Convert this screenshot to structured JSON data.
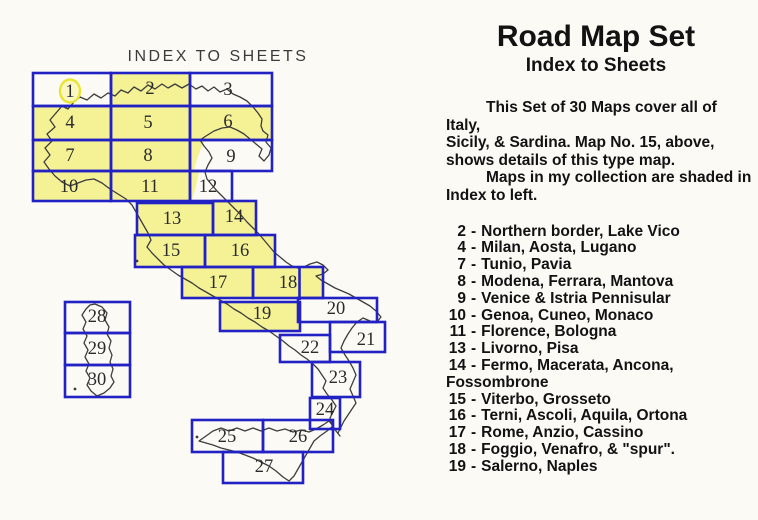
{
  "page": {
    "background": "#fbfaf5"
  },
  "header": {
    "title": "Road Map Set",
    "subtitle": "Index to Sheets"
  },
  "intro": {
    "lines": [
      {
        "text": "This Set of 30 Maps cover all of Italy,",
        "indent": true
      },
      {
        "text": "Sicily, & Sardina.  Map No. 15, above,",
        "indent": false
      },
      {
        "text": "shows details of this type map.",
        "indent": false
      },
      {
        "text": "Maps in my collection are shaded in",
        "indent": true
      },
      {
        "text": "Index to left.",
        "indent": false
      }
    ]
  },
  "sheet_list": {
    "separator": "-",
    "items": [
      {
        "num": "2",
        "desc": "Northern border, Lake Vico"
      },
      {
        "num": "4",
        "desc": "Milan, Aosta, Lugano"
      },
      {
        "num": "7",
        "desc": "Tunio, Pavia"
      },
      {
        "num": "8",
        "desc": "Modena, Ferrara, Mantova"
      },
      {
        "num": "9",
        "desc": "Venice & Istria Pennisular"
      },
      {
        "num": "10",
        "desc": "Genoa, Cuneo, Monaco"
      },
      {
        "num": "11",
        "desc": "Florence, Bologna"
      },
      {
        "num": "13",
        "desc": "Livorno, Pisa"
      },
      {
        "num": "14",
        "desc": "Fermo, Macerata, Ancona,",
        "continuation": "Fossombrone"
      },
      {
        "num": "15",
        "desc": "Viterbo, Grosseto"
      },
      {
        "num": "16",
        "desc": "Terni, Ascoli, Aquila, Ortona"
      },
      {
        "num": "17",
        "desc": "Rome, Anzio, Cassino"
      },
      {
        "num": "18",
        "desc": "Foggio, Venafro, & \"spur\"."
      },
      {
        "num": "19",
        "desc": "Salerno, Naples"
      }
    ]
  },
  "index_map": {
    "title": "INDEX TO SHEETS",
    "total_sheets": 30,
    "highlighted_sheet": "1",
    "colors": {
      "grid": "#2222c4",
      "shaded": "#f5f295",
      "coastline": "#3d3d3d",
      "highlight_ring": "#e9e433",
      "highlight_fill": "#faf7c0",
      "number": "#2b2b2b",
      "map_title": "#3b3b3b"
    },
    "cells": [
      {
        "n": "1",
        "x": 33,
        "y": 73,
        "w": 78,
        "h": 33,
        "shaded": false,
        "ring": true,
        "lx": 70,
        "ly": 92
      },
      {
        "n": "2",
        "x": 111,
        "y": 73,
        "w": 79,
        "h": 33,
        "shaded": true,
        "ring": false,
        "lx": 150,
        "ly": 89
      },
      {
        "n": "3",
        "x": 190,
        "y": 73,
        "w": 82,
        "h": 33,
        "shaded": false,
        "ring": false,
        "lx": 228,
        "ly": 90
      },
      {
        "n": "4",
        "x": 33,
        "y": 106,
        "w": 78,
        "h": 34,
        "shaded": true,
        "ring": false,
        "lx": 70,
        "ly": 123
      },
      {
        "n": "5",
        "x": 111,
        "y": 106,
        "w": 79,
        "h": 34,
        "shaded": true,
        "ring": false,
        "lx": 148,
        "ly": 123
      },
      {
        "n": "6",
        "x": 190,
        "y": 106,
        "w": 82,
        "h": 34,
        "shaded": true,
        "ring": false,
        "lx": 228,
        "ly": 122
      },
      {
        "n": "7",
        "x": 33,
        "y": 140,
        "w": 78,
        "h": 31,
        "shaded": true,
        "ring": false,
        "lx": 70,
        "ly": 156
      },
      {
        "n": "8",
        "x": 111,
        "y": 140,
        "w": 79,
        "h": 31,
        "shaded": true,
        "ring": false,
        "lx": 148,
        "ly": 156
      },
      {
        "n": "9",
        "x": 190,
        "y": 140,
        "w": 82,
        "h": 31,
        "shaded": false,
        "ring": false,
        "lx": 231,
        "ly": 157
      },
      {
        "n": "10",
        "x": 33,
        "y": 171,
        "w": 78,
        "h": 30,
        "shaded": true,
        "ring": false,
        "lx": 69,
        "ly": 187
      },
      {
        "n": "11",
        "x": 111,
        "y": 171,
        "w": 79,
        "h": 30,
        "shaded": true,
        "ring": false,
        "lx": 150,
        "ly": 187
      },
      {
        "n": "12",
        "x": 190,
        "y": 171,
        "w": 42,
        "h": 30,
        "shaded": false,
        "ring": false,
        "lx": 208,
        "ly": 187
      },
      {
        "n": "13",
        "x": 137,
        "y": 203,
        "w": 76,
        "h": 32,
        "shaded": true,
        "ring": false,
        "lx": 172,
        "ly": 219
      },
      {
        "n": "14",
        "x": 213,
        "y": 201,
        "w": 43,
        "h": 34,
        "shaded": true,
        "ring": false,
        "lx": 234,
        "ly": 217
      },
      {
        "n": "15",
        "x": 135,
        "y": 235,
        "w": 70,
        "h": 32,
        "shaded": true,
        "ring": false,
        "lx": 171,
        "ly": 251
      },
      {
        "n": "16",
        "x": 205,
        "y": 235,
        "w": 70,
        "h": 32,
        "shaded": true,
        "ring": false,
        "lx": 240,
        "ly": 251
      },
      {
        "n": "17",
        "x": 182,
        "y": 267,
        "w": 71,
        "h": 31,
        "shaded": true,
        "ring": false,
        "lx": 218,
        "ly": 283
      },
      {
        "n": "18",
        "x": 253,
        "y": 267,
        "w": 70,
        "h": 31,
        "shaded": true,
        "ring": false,
        "lx": 288,
        "ly": 283
      },
      {
        "n": "19",
        "x": 220,
        "y": 302,
        "w": 80,
        "h": 29,
        "shaded": true,
        "ring": false,
        "lx": 262,
        "ly": 314
      },
      {
        "n": "20",
        "x": 298,
        "y": 298,
        "w": 79,
        "h": 24,
        "shaded": false,
        "ring": false,
        "lx": 336,
        "ly": 309
      },
      {
        "n": "21",
        "x": 330,
        "y": 322,
        "w": 55,
        "h": 30,
        "shaded": false,
        "ring": false,
        "lx": 366,
        "ly": 340
      },
      {
        "n": "22",
        "x": 280,
        "y": 335,
        "w": 50,
        "h": 27,
        "shaded": false,
        "ring": false,
        "lx": 310,
        "ly": 348
      },
      {
        "n": "23",
        "x": 312,
        "y": 362,
        "w": 48,
        "h": 35,
        "shaded": false,
        "ring": false,
        "lx": 338,
        "ly": 378
      },
      {
        "n": "24",
        "x": 310,
        "y": 398,
        "w": 30,
        "h": 31,
        "shaded": false,
        "ring": false,
        "lx": 325,
        "ly": 410
      },
      {
        "n": "25",
        "x": 192,
        "y": 420,
        "w": 71,
        "h": 32,
        "shaded": false,
        "ring": false,
        "lx": 227,
        "ly": 437
      },
      {
        "n": "26",
        "x": 263,
        "y": 420,
        "w": 70,
        "h": 32,
        "shaded": false,
        "ring": false,
        "lx": 298,
        "ly": 437
      },
      {
        "n": "27",
        "x": 223,
        "y": 452,
        "w": 80,
        "h": 31,
        "shaded": false,
        "ring": false,
        "lx": 264,
        "ly": 467
      },
      {
        "n": "28",
        "x": 65,
        "y": 302,
        "w": 65,
        "h": 31,
        "shaded": false,
        "ring": false,
        "lx": 97,
        "ly": 317
      },
      {
        "n": "29",
        "x": 65,
        "y": 333,
        "w": 65,
        "h": 32,
        "shaded": false,
        "ring": false,
        "lx": 97,
        "ly": 349
      },
      {
        "n": "30",
        "x": 65,
        "y": 365,
        "w": 65,
        "h": 32,
        "shaded": false,
        "ring": false,
        "lx": 97,
        "ly": 380
      }
    ]
  }
}
